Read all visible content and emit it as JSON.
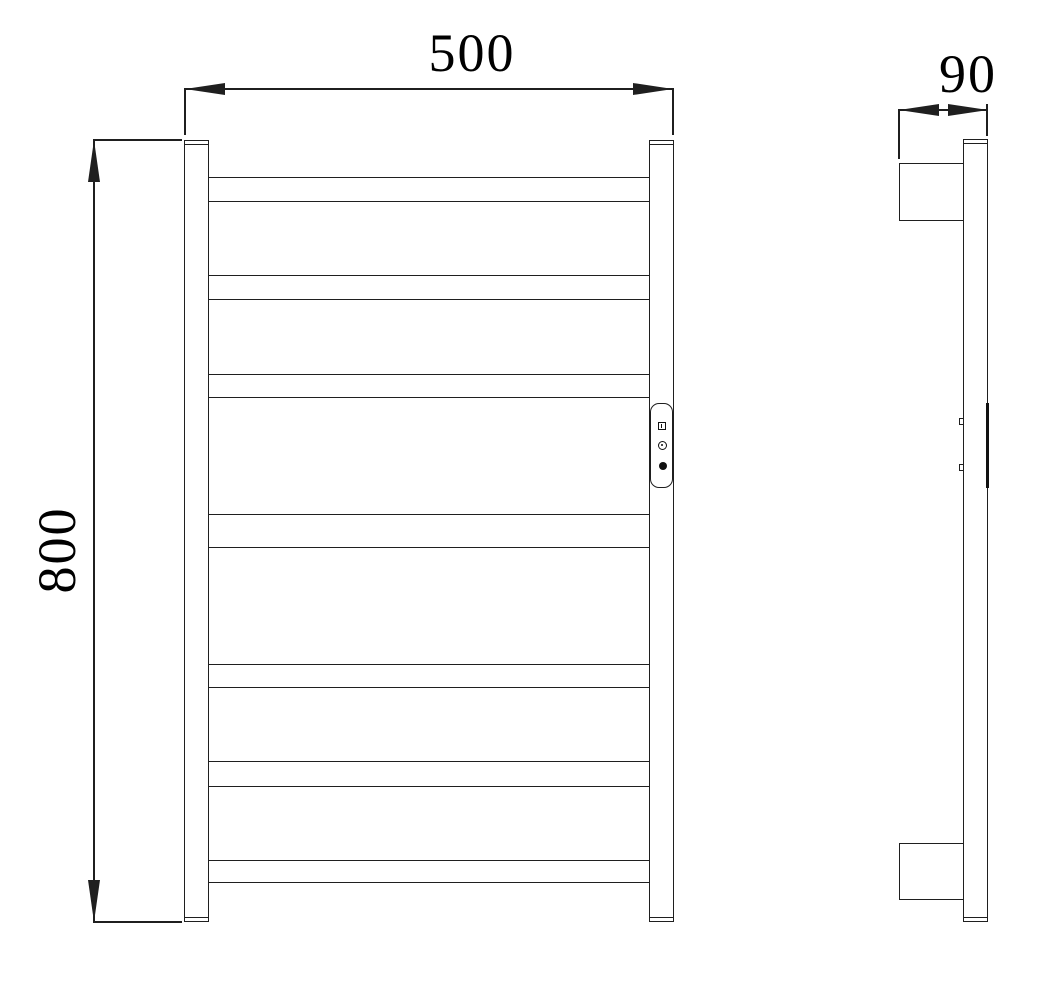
{
  "drawing": {
    "type": "technical-dimension-drawing",
    "subject": "heated towel rail ladder, front and side orthographic views",
    "line_color": "#1f1f1f",
    "background_color": "#ffffff",
    "front_view": {
      "width_dimension_label": "500",
      "height_dimension_label": "800",
      "rung_count": 7,
      "has_control_panel": true,
      "control_panel_icons": [
        "display-icon",
        "ring-button-icon",
        "solid-button-icon"
      ]
    },
    "side_view": {
      "depth_dimension_label": "90",
      "bracket_count": 2
    }
  }
}
